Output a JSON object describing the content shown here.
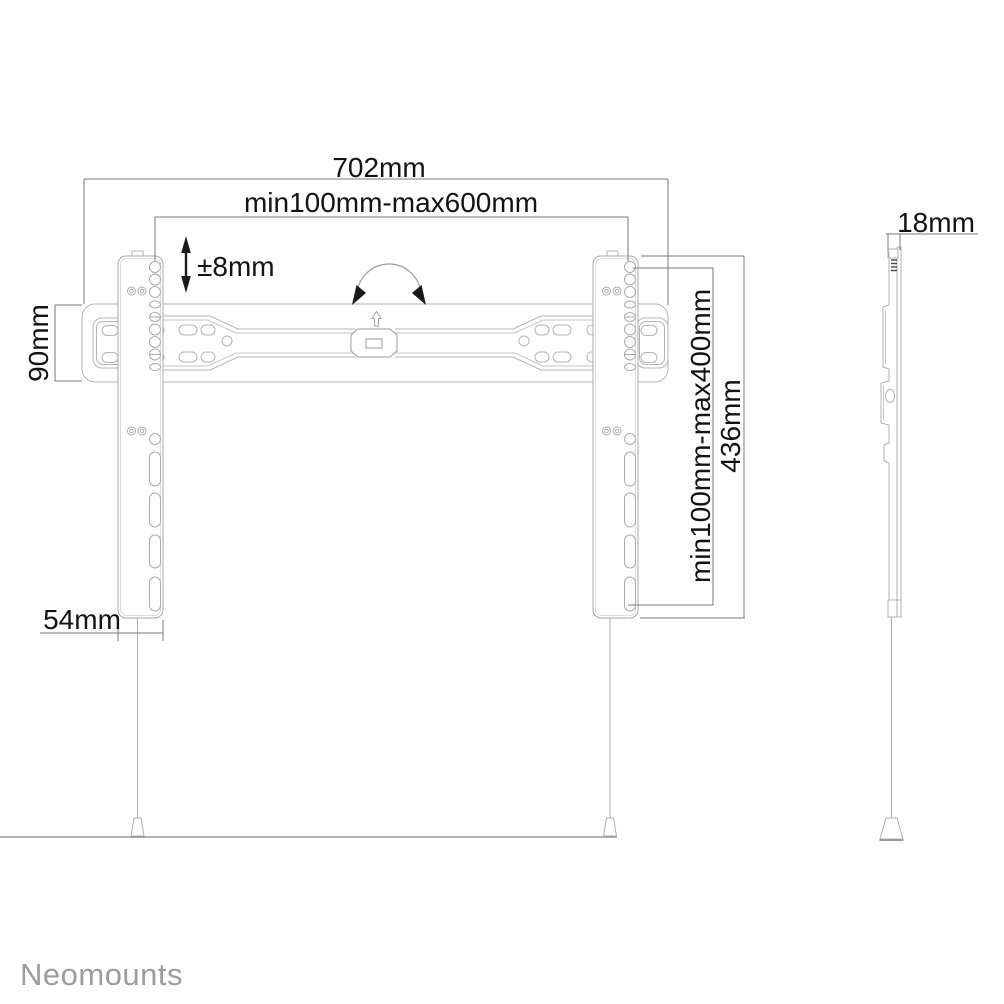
{
  "diagram": {
    "type": "technical-drawing",
    "subject": "tv-wall-mount-dimensions",
    "dimensions": {
      "overall_width": "702mm",
      "horizontal_hole_range": "min100mm-max600mm",
      "height_adjustment": "±8mm",
      "rail_height": "90mm",
      "bracket_width": "54mm",
      "vertical_hole_range": "min100mm-max400mm",
      "bracket_height": "436mm",
      "profile_depth": "18mm"
    },
    "brand": "Neomounts",
    "colors": {
      "background": "#ffffff",
      "drawing_line": "#b4b4b4",
      "drawing_line_light": "#c6c6c6",
      "dimension_line": "#7a7a7a",
      "dimension_text": "#121212",
      "arrow_fill": "#1a1a1a",
      "brand_text": "#9c9c9c"
    }
  }
}
